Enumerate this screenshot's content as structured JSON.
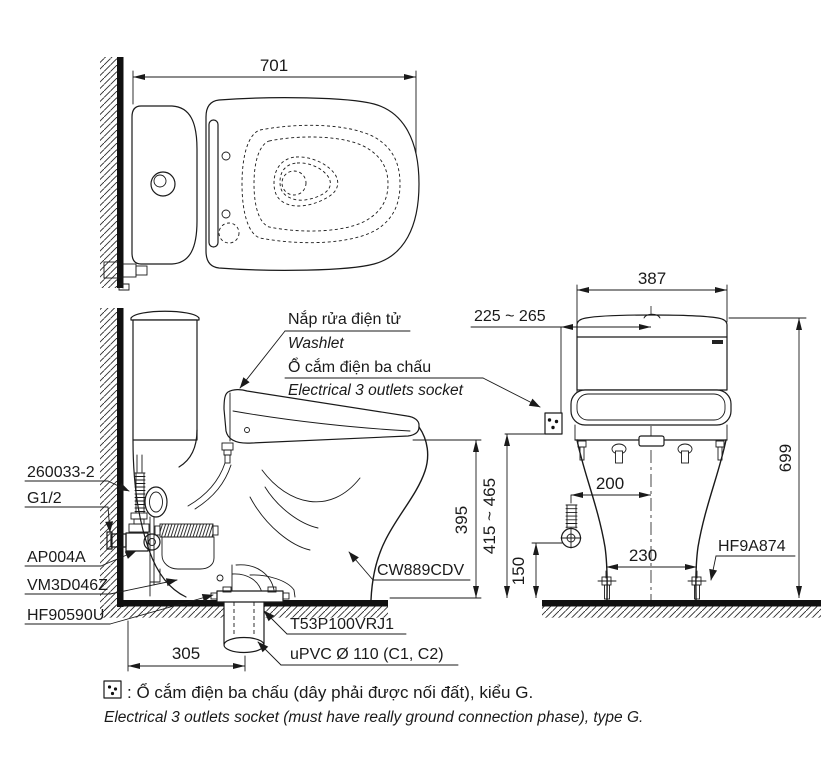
{
  "dims": {
    "top_width": "701",
    "bowl_height": "395",
    "drain_offset": "305",
    "tank_width": "387",
    "socket_side_offset": "225 ~ 265",
    "total_height": "699",
    "socket_height": "415 ~ 465",
    "supply_height": "150",
    "supply_side_offset": "200",
    "bolt_pitch": "230"
  },
  "parts": {
    "bolt": "260033-2",
    "thread": "G1/2",
    "stop_valve": "AP004A",
    "gasket": "VM3D046Z",
    "flange": "HF90590U",
    "bowl": "CW889CDV",
    "drain_socket": "T53P100VRJ1",
    "drain_pipe": "uPVC Ø 110 (C1, C2)",
    "bolt_cap": "HF9A874"
  },
  "callouts": {
    "washlet_vi": "Nắp rửa điện tử",
    "washlet_en": "Washlet",
    "socket_vi": "Ổ cắm điện ba chấu",
    "socket_en": "Electrical 3 outlets socket"
  },
  "footnote": {
    "vi": ": Ổ cắm điện ba chấu (dây phải được nối đất), kiểu G.",
    "en": "Electrical 3 outlets socket (must have really ground connection phase), type G."
  },
  "colors": {
    "line": "#1a1a1a",
    "background": "#ffffff"
  }
}
